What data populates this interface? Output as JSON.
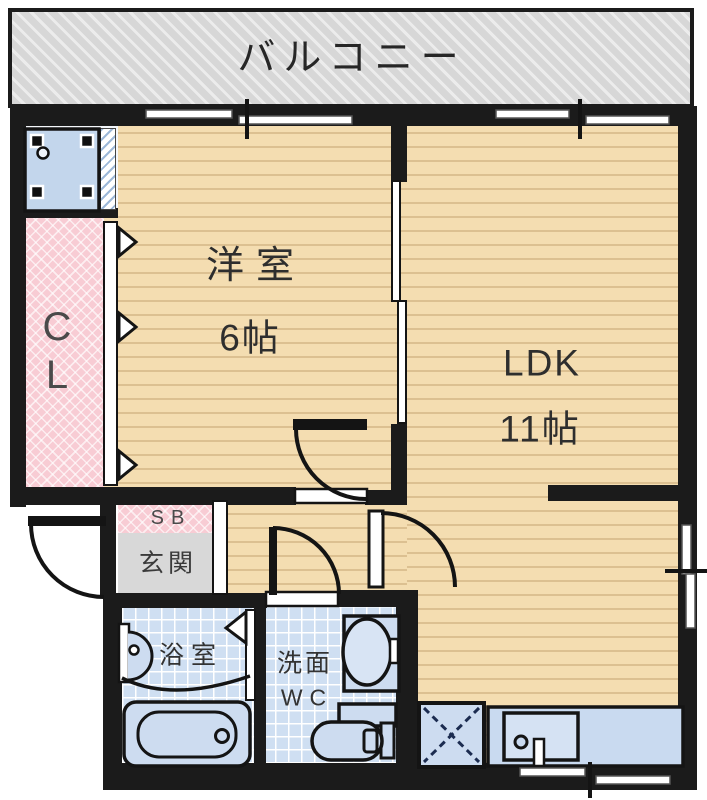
{
  "floorplan": {
    "balcony": {
      "label": "バルコニー"
    },
    "rooms": {
      "western_room": {
        "name": "洋室",
        "size": "6帖"
      },
      "ldk": {
        "name": "LDK",
        "size": "11帖"
      },
      "closet": {
        "label": "CL"
      },
      "entrance": {
        "shoe_box_label": "SB",
        "label": "玄関"
      },
      "bathroom": {
        "label": "浴室"
      },
      "washroom_wc": {
        "line1": "洗面",
        "line2": "WC"
      }
    },
    "fixtures": [
      "washing-machine-pan",
      "bathtub",
      "washbasin",
      "toilet",
      "kitchen-sink-counter",
      "refrigerator-space",
      "sliding-window",
      "sliding-door",
      "hinged-door",
      "folding-closet-door"
    ],
    "colors": {
      "wall": "#1b1b1b",
      "wood_floor": "#f4ddb1",
      "wood_stripe": "#dcc091",
      "tile_blue": "#cfdff2",
      "fixture_blue": "#cddcf0",
      "closet_pink": "#f8ccd4",
      "entrance_gray": "#d8d8d8",
      "balcony_gray": "#d7d7d7"
    }
  }
}
